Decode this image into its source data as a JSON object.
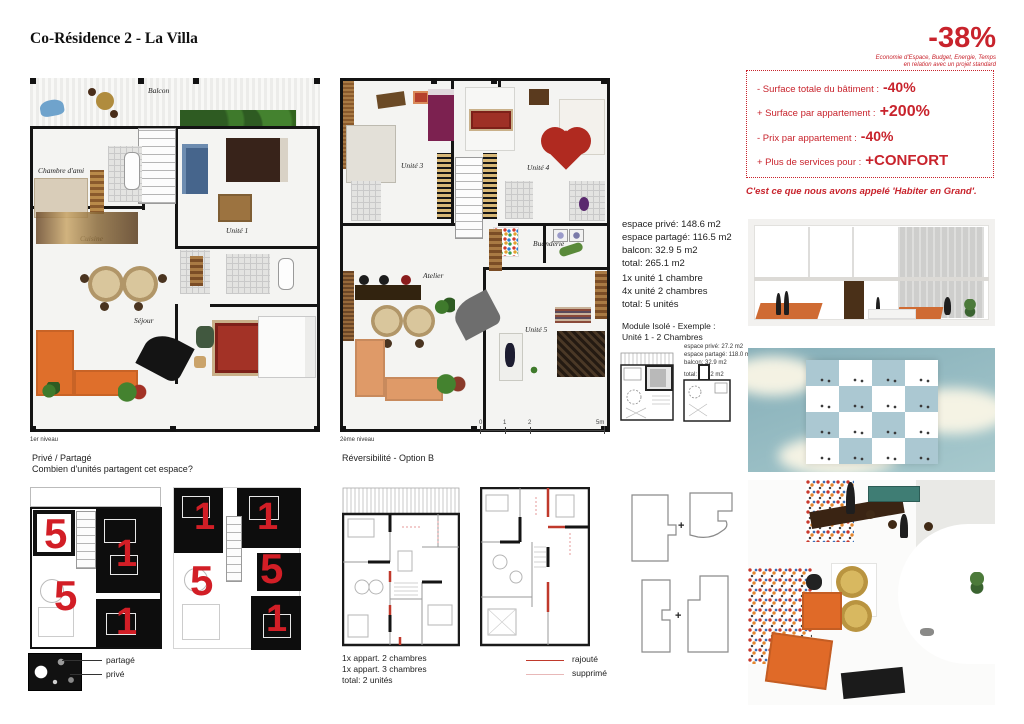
{
  "header": {
    "title": "Co-Résidence 2 - La Villa",
    "stat": "-38%",
    "caption1": "Economie d'Espace, Budget, Energie, Temps",
    "caption2": "en relation avec un projet standard"
  },
  "benefits": {
    "items": [
      {
        "label": "- Surface totale du bâtiment :",
        "value": "-40%"
      },
      {
        "label": "+ Surface par appartement :",
        "value": "+200%"
      },
      {
        "label": "- Prix par appartement :",
        "value": "-40%"
      },
      {
        "label": "+ Plus de services pour :",
        "value": "+CONFORT"
      }
    ],
    "tagline": "C'est ce que nous avons appelé 'Habiter en Grand'."
  },
  "plan1": {
    "caption": "1er niveau",
    "labels": {
      "balcon": "Balcon",
      "chambre": "Chambre d'ami",
      "cuisine": "Cuisine",
      "sejour": "Séjour",
      "unite1": "Unité 1",
      "unite2": "Unité 2"
    }
  },
  "plan2": {
    "caption": "2ème niveau",
    "labels": {
      "unite3": "Unité 3",
      "unite4": "Unité 4",
      "buanderie": "Buanderie",
      "atelier": "Atelier",
      "unite5": "Unité 5"
    },
    "scale": [
      "0",
      "1",
      "2",
      "5m"
    ]
  },
  "summary": {
    "area": [
      "espace privé: 148.6 m2",
      "espace partagé: 116.5 m2",
      "balcon: 32.9 5 m2",
      "total: 265.1 m2"
    ],
    "units": [
      "1x unité 1 chambre",
      "4x unité 2 chambres",
      "total: 5 unités"
    ]
  },
  "module": {
    "title1": "Module Isolé - Exemple :",
    "title2": "Unité 1 - 2 Chambres",
    "details": [
      "espace privé: 27.2 m2",
      "espace partagé: 118.0 m2",
      "balcon: 32.9 m2",
      "total: 145.2 m2"
    ]
  },
  "prive": {
    "title": "Privé / Partagé",
    "subtitle": "Combien d'unités partagent cet espace?",
    "left": [
      "5",
      "1",
      "5",
      "1"
    ],
    "right": [
      "1",
      "1",
      "5",
      "5",
      "1"
    ],
    "legend_partage": "partagé",
    "legend_prive": "privé"
  },
  "rev": {
    "title": "Réversibilité - Option B",
    "lines": [
      "1x appart. 2 chambres",
      "1x appart. 3 chambres",
      "total: 2 unités"
    ],
    "legend_rajoute": "rajouté",
    "legend_supprime": "supprimé"
  },
  "modules": {
    "plus": "+"
  },
  "colors": {
    "accent": "#c8232c",
    "orange": "#df6f2b",
    "sky": "#8fb7be"
  }
}
